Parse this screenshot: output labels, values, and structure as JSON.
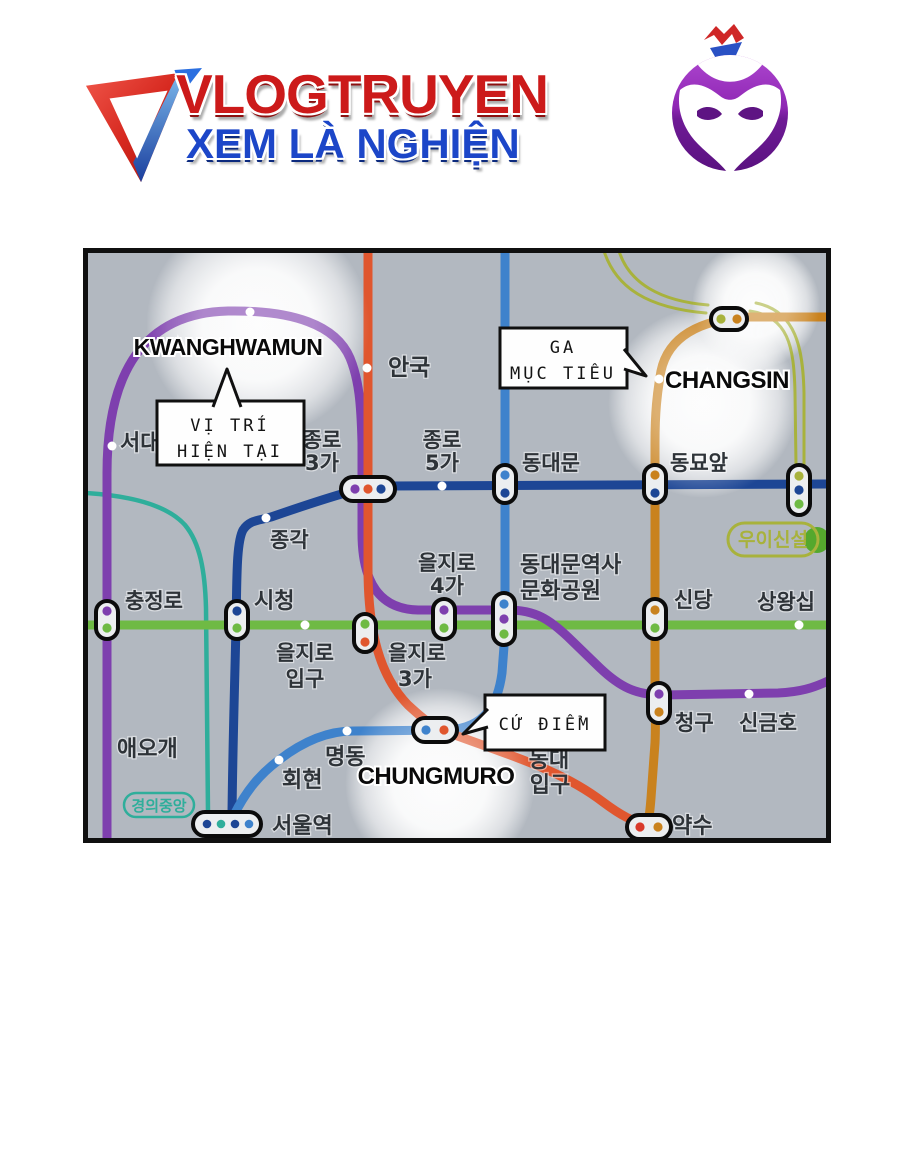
{
  "header": {
    "site_name": "VLOGTRUYEN",
    "tagline": "XEM LÀ NGHIỆN"
  },
  "map": {
    "callouts": {
      "current_line1": "VỊ TRÍ",
      "current_line2": "HIỆN TẠI",
      "target_line1": "GA",
      "target_line2": "MỤC TIÊU",
      "base": "CỨ ĐIỂM"
    },
    "en": {
      "kwanghwamun": "KWANGHWAMUN",
      "changsin": "CHANGSIN",
      "chungmuro": "CHUNGMURO"
    },
    "kr": {
      "seodae": "서대",
      "anguk": "안국",
      "jongno3ga_1": "종로",
      "jongno3ga_2": "3가",
      "jongno5ga_1": "종로",
      "jongno5ga_2": "5가",
      "dongdaemun": "동대문",
      "dongmyoap": "동묘앞",
      "jonggak": "종각",
      "euljiro4ga_1": "을지로",
      "euljiro4ga_2": "4가",
      "ddm_park_1": "동대문역사",
      "ddm_park_2": "문화공원",
      "chungjeongno": "충정로",
      "sicheong": "시청",
      "sindang": "신당",
      "sangwangsimni": "상왕십",
      "euljiro_ipgu_1": "을지로",
      "euljiro_ipgu_2": "입구",
      "euljiro3ga_1": "을지로",
      "euljiro3ga_2": "3가",
      "aeogae": "애오개",
      "myeongdong": "명동",
      "hoehyeon": "회현",
      "cheonggu": "청구",
      "singeumho": "신금호",
      "dongdae_ipgu_1": "동대",
      "dongdae_ipgu_2": "입구",
      "yaksu": "약수",
      "seoul_station": "서울역"
    },
    "badges": {
      "uisinseol": "우이신설",
      "gyeongui_jungang": "경의중앙"
    },
    "line_colors": {
      "line1": "#1d4695",
      "line2": "#6fba44",
      "line3": "#e0562e",
      "line4": "#3e82cc",
      "line5": "#7e3fae",
      "line6": "#c9821e",
      "ui_sinseol": "#a8b23c",
      "gyeongui": "#2fae9b"
    }
  },
  "brand_colors": {
    "title_red": "#cc1a1a",
    "tagline_blue": "#1c46c8",
    "mascot_purple": "#7a1f9e"
  }
}
